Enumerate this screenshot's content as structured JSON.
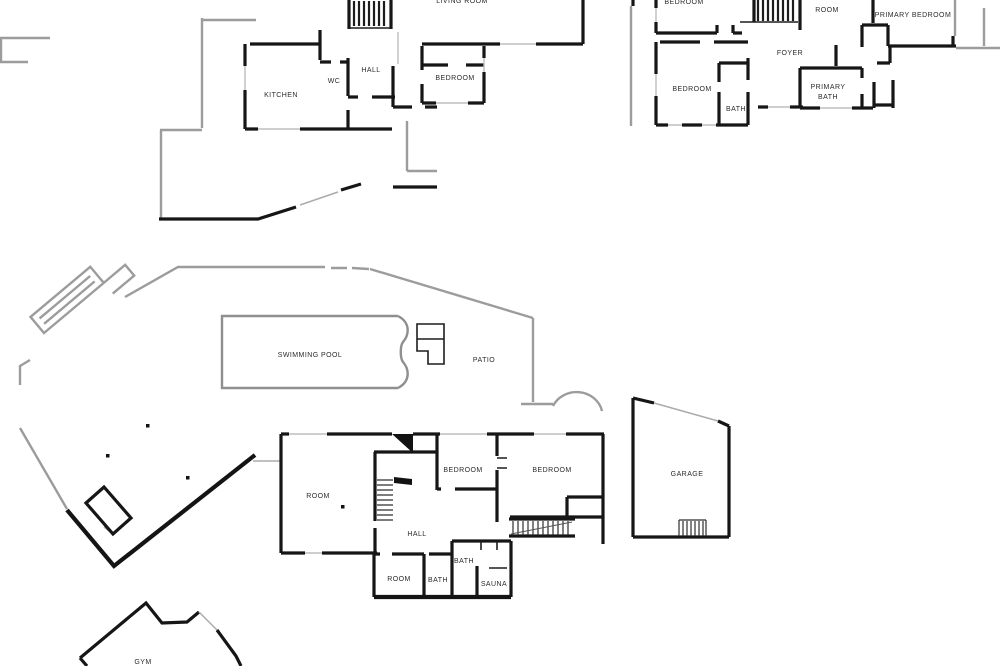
{
  "document": {
    "type": "architectural-floor-plan",
    "description_visible_text_only": true
  },
  "colors": {
    "wall": "#161616",
    "deck_outline": "#9c9c9c",
    "background": "#ffffff"
  },
  "plans": {
    "upper_left": {
      "rooms": {
        "living_room": "LIVING ROOM",
        "kitchen": "KITCHEN",
        "wc": "WC",
        "hall": "HALL",
        "bedroom": "BEDROOM"
      }
    },
    "upper_right": {
      "rooms": {
        "bedroom_top": "BEDROOM",
        "room": "ROOM",
        "primary_bedroom": "PRIMARY BEDROOM",
        "foyer": "FOYER",
        "bedroom": "BEDROOM",
        "bath": "BATH",
        "primary_bath_line1": "PRIMARY",
        "primary_bath_line2": "BATH"
      }
    },
    "lower": {
      "rooms": {
        "swimming_pool": "SWIMMING POOL",
        "patio": "PATIO",
        "room": "ROOM",
        "bedroom_left": "BEDROOM",
        "bedroom_right": "BEDROOM",
        "garage": "GARAGE",
        "hall": "HALL",
        "room_lower": "ROOM",
        "bath_lower": "BATH",
        "bath_upper": "BATH",
        "sauna": "SAUNA",
        "gym": "GYM"
      }
    }
  }
}
